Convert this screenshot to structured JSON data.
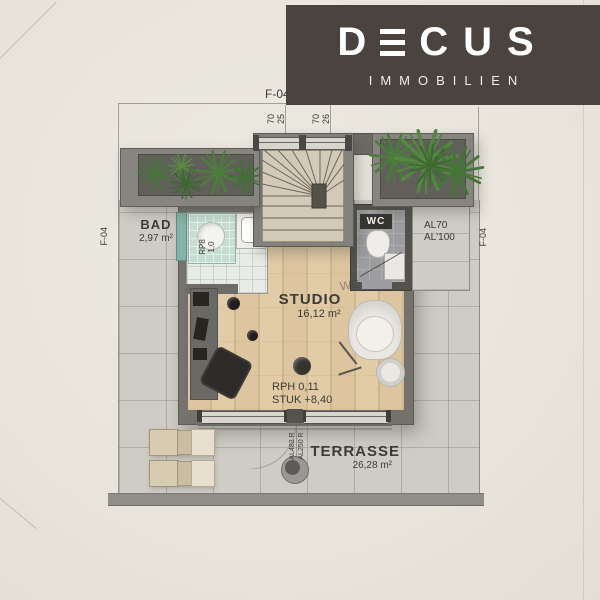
{
  "logo": {
    "d": "D",
    "rest": "CUS",
    "subtitle": "IMMOBILIEN",
    "bg": "#4b443e"
  },
  "plan": {
    "rooms": {
      "bad": {
        "name": "BAD",
        "area": "2,97 m²"
      },
      "studio": {
        "name": "STUDIO",
        "area": "16,12 m²"
      },
      "wc": {
        "name": "WC",
        "floor_mark": "WC"
      },
      "terrasse": {
        "name": "TERRASSE",
        "area": "26,28 m²"
      }
    },
    "levels": {
      "rph": "RPH 0,11",
      "stuk": "STUK +8,40"
    },
    "sections": {
      "top": "F-04",
      "left": "F-04",
      "right": "F-04"
    },
    "windows": {
      "left": {
        "w": "70",
        "h": "25"
      },
      "right": {
        "w": "70",
        "h": "26"
      }
    },
    "doors": {
      "line1": "AL482 R",
      "line2": "AL250 R"
    },
    "vent": {
      "line1": "AL70",
      "line2": "AL'100"
    },
    "shower": {
      "line1": "RP8",
      "line2": "1,0"
    }
  },
  "colors": {
    "paper": "#eae6de",
    "logo_bg": "#4b443e",
    "wall": "#7b7974",
    "wood": "#dcc49e",
    "apron": "#cfccc5",
    "glass": "#84b2a6",
    "plant": "#4a7c3a",
    "ink": "#3c3b38"
  }
}
